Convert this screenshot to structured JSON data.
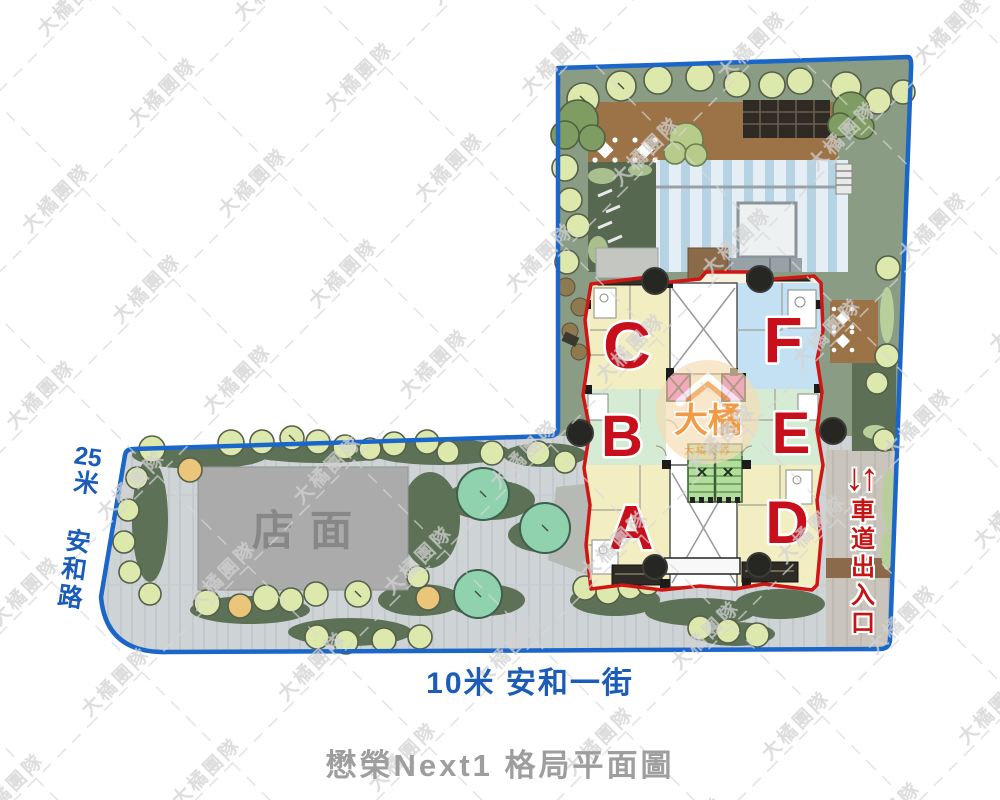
{
  "title": "懋榮Next1 格局平面圖",
  "watermark": {
    "text": "大橘團隊"
  },
  "center_logo": {
    "brand": "大橘",
    "team": "大橘團隊"
  },
  "roads": {
    "left_digits": "25",
    "left_name": "米 安和路",
    "bottom": "10米 安和一街",
    "driveway_arrows": "↓↑",
    "driveway": "車道出入口"
  },
  "site": {
    "storefront": "店面"
  },
  "building": {
    "units": [
      {
        "label": "A"
      },
      {
        "label": "B"
      },
      {
        "label": "C"
      },
      {
        "label": "D"
      },
      {
        "label": "E"
      },
      {
        "label": "F"
      }
    ]
  },
  "colors": {
    "boundary_blue": "#1b66c9",
    "building_outline_red": "#d01515",
    "unit_yellow": "#f3eec2",
    "unit_green": "#d5ebd3",
    "unit_blue": "#c3e1f2",
    "elevator_magenta": "#ea3cc9",
    "stairs_green": "#b2de9c",
    "road_text_blue": "#1a5cb8",
    "driveway_text_red": "#c61414",
    "title_gray": "#9e9e9e",
    "site_green": "#8a9c84",
    "plaza_gray": "#ced3d6"
  }
}
